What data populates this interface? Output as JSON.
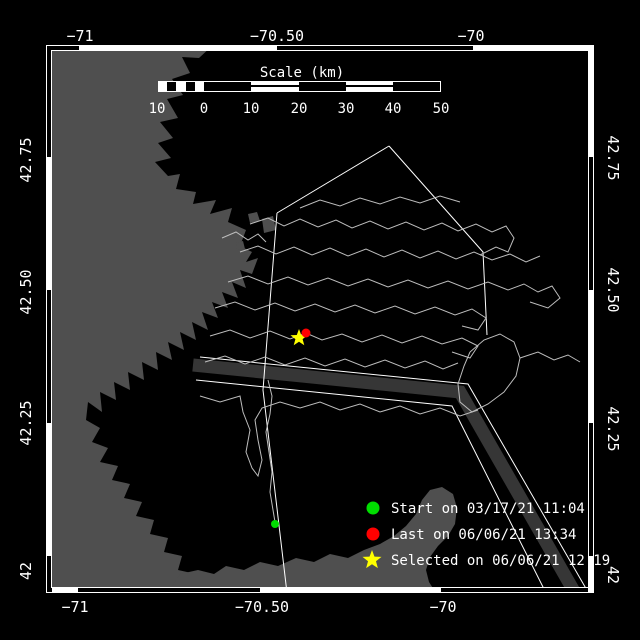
{
  "figure": {
    "width": 640,
    "height": 640,
    "bg": "#000000"
  },
  "map_colors": {
    "land": "#4f4f4f",
    "water": "#000000",
    "track": "#bdbdbd",
    "boundary_line": "#ffffff",
    "shipping_lane": "#363636",
    "frame": "#ffffff"
  },
  "axes": {
    "frame": {
      "x": 46,
      "y": 45,
      "w": 548,
      "h": 548
    },
    "top": {
      "baseline_y": 41,
      "labels": [
        {
          "text": "−71",
          "x": 80
        },
        {
          "text": "−70.50",
          "x": 277
        },
        {
          "text": "−70",
          "x": 471
        }
      ]
    },
    "bottom": {
      "baseline_y": 612,
      "labels": [
        {
          "text": "−71",
          "x": 75
        },
        {
          "text": "−70.50",
          "x": 262
        },
        {
          "text": "−70",
          "x": 443
        }
      ]
    },
    "left": {
      "x": 31,
      "labels": [
        {
          "text": "42.75",
          "y": 160
        },
        {
          "text": "42.50",
          "y": 292
        },
        {
          "text": "42.25",
          "y": 423
        },
        {
          "text": "42",
          "y": 571
        }
      ]
    },
    "right": {
      "x": 608,
      "labels": [
        {
          "text": "42.75",
          "y": 158
        },
        {
          "text": "42.50",
          "y": 290
        },
        {
          "text": "42.25",
          "y": 429
        },
        {
          "text": "42",
          "y": 575
        }
      ]
    },
    "border": {
      "thickness": 6,
      "top": {
        "boundaries": [
          46,
          79,
          277,
          473,
          594
        ],
        "first": "black"
      },
      "bottom": {
        "boundaries": [
          46,
          78,
          260,
          441,
          594
        ],
        "first": "white"
      },
      "left": {
        "boundaries": [
          45,
          157,
          290,
          423,
          556,
          593
        ],
        "first": "black"
      },
      "right": {
        "boundaries": [
          45,
          157,
          290,
          423,
          556,
          593
        ],
        "first": "white"
      }
    }
  },
  "scalebar": {
    "title": "Scale (km)",
    "title_x": 302,
    "title_y": 77,
    "bar": {
      "x": 158,
      "y": 81,
      "w": 283,
      "h": 11
    },
    "segments": [
      {
        "x1": 158,
        "x2": 167,
        "fill": "white",
        "striped": false
      },
      {
        "x1": 167,
        "x2": 176,
        "fill": "black",
        "striped": false
      },
      {
        "x1": 176,
        "x2": 186,
        "fill": "white",
        "striped": false
      },
      {
        "x1": 186,
        "x2": 195,
        "fill": "black",
        "striped": false
      },
      {
        "x1": 195,
        "x2": 204,
        "fill": "white",
        "striped": false
      },
      {
        "x1": 204,
        "x2": 251,
        "fill": "black",
        "striped": false
      },
      {
        "x1": 251,
        "x2": 299,
        "fill": "white",
        "striped": true
      },
      {
        "x1": 299,
        "x2": 346,
        "fill": "black",
        "striped": false
      },
      {
        "x1": 346,
        "x2": 393,
        "fill": "white",
        "striped": true
      },
      {
        "x1": 393,
        "x2": 441,
        "fill": "black",
        "striped": false
      }
    ],
    "ticks": [
      {
        "label": "10",
        "x": 157
      },
      {
        "label": "0",
        "x": 204
      },
      {
        "label": "10",
        "x": 251
      },
      {
        "label": "20",
        "x": 299
      },
      {
        "label": "30",
        "x": 346
      },
      {
        "label": "40",
        "x": 393
      },
      {
        "label": "50",
        "x": 441
      }
    ],
    "tick_baseline_y": 113
  },
  "legend": {
    "marker_x": 373,
    "label_x": 391,
    "row_y": [
      508,
      534,
      560
    ],
    "items": [
      {
        "id": "start",
        "marker": "circle",
        "color": "#00dd00",
        "label": "Start on 03/17/21 11:04"
      },
      {
        "id": "last",
        "marker": "circle",
        "color": "#ff0000",
        "label": "Last on 06/06/21 13:34"
      },
      {
        "id": "selected",
        "marker": "star",
        "color": "#ffff00",
        "label": "Selected on 06/06/21 12:19"
      }
    ]
  },
  "markers": {
    "start": {
      "x": 275,
      "y": 524,
      "r": 4,
      "color": "#00dd00"
    },
    "last": {
      "x": 306,
      "y": 333,
      "r": 4.5,
      "color": "#ff0000"
    },
    "selected": {
      "x": 299,
      "y": 338,
      "r": 9,
      "color": "#ffff00"
    }
  },
  "land_polygons": [
    [
      [
        46,
        45
      ],
      [
        213,
        45
      ],
      [
        199,
        58
      ],
      [
        182,
        57
      ],
      [
        190,
        73
      ],
      [
        172,
        79
      ],
      [
        183,
        95
      ],
      [
        167,
        99
      ],
      [
        178,
        118
      ],
      [
        160,
        122
      ],
      [
        173,
        138
      ],
      [
        158,
        143
      ],
      [
        171,
        158
      ],
      [
        155,
        162
      ],
      [
        168,
        176
      ],
      [
        180,
        174
      ],
      [
        176,
        189
      ],
      [
        196,
        192
      ],
      [
        193,
        204
      ],
      [
        216,
        200
      ],
      [
        210,
        214
      ],
      [
        232,
        208
      ],
      [
        228,
        222
      ],
      [
        246,
        230
      ],
      [
        240,
        246
      ],
      [
        252,
        252
      ],
      [
        246,
        262
      ],
      [
        258,
        258
      ],
      [
        252,
        274
      ],
      [
        240,
        270
      ],
      [
        246,
        288
      ],
      [
        232,
        282
      ],
      [
        238,
        298
      ],
      [
        222,
        292
      ],
      [
        228,
        308
      ],
      [
        212,
        302
      ],
      [
        218,
        318
      ],
      [
        202,
        312
      ],
      [
        208,
        330
      ],
      [
        192,
        322
      ],
      [
        196,
        340
      ],
      [
        180,
        332
      ],
      [
        184,
        350
      ],
      [
        168,
        342
      ],
      [
        172,
        360
      ],
      [
        156,
        352
      ],
      [
        158,
        370
      ],
      [
        142,
        362
      ],
      [
        144,
        380
      ],
      [
        128,
        372
      ],
      [
        130,
        390
      ],
      [
        114,
        382
      ],
      [
        116,
        400
      ],
      [
        100,
        392
      ],
      [
        102,
        412
      ],
      [
        88,
        402
      ],
      [
        86,
        420
      ],
      [
        100,
        428
      ],
      [
        92,
        442
      ],
      [
        108,
        448
      ],
      [
        100,
        462
      ],
      [
        118,
        466
      ],
      [
        112,
        480
      ],
      [
        130,
        484
      ],
      [
        124,
        498
      ],
      [
        142,
        502
      ],
      [
        136,
        516
      ],
      [
        154,
        520
      ],
      [
        150,
        534
      ],
      [
        168,
        538
      ],
      [
        164,
        552
      ],
      [
        182,
        556
      ],
      [
        178,
        570
      ],
      [
        196,
        574
      ],
      [
        192,
        588
      ],
      [
        210,
        592
      ],
      [
        208,
        593
      ],
      [
        46,
        593
      ]
    ],
    [
      [
        168,
        593
      ],
      [
        180,
        574
      ],
      [
        198,
        570
      ],
      [
        214,
        574
      ],
      [
        226,
        566
      ],
      [
        244,
        570
      ],
      [
        260,
        562
      ],
      [
        278,
        566
      ],
      [
        296,
        558
      ],
      [
        314,
        562
      ],
      [
        330,
        554
      ],
      [
        348,
        558
      ],
      [
        364,
        550
      ],
      [
        380,
        544
      ],
      [
        394,
        536
      ],
      [
        406,
        526
      ],
      [
        416,
        514
      ],
      [
        422,
        500
      ],
      [
        430,
        490
      ],
      [
        442,
        487
      ],
      [
        453,
        494
      ],
      [
        457,
        508
      ],
      [
        455,
        524
      ],
      [
        448,
        536
      ],
      [
        438,
        546
      ],
      [
        430,
        557
      ],
      [
        426,
        570
      ],
      [
        429,
        582
      ],
      [
        436,
        593
      ]
    ],
    [
      [
        248,
        214
      ],
      [
        257,
        212
      ],
      [
        260,
        221
      ],
      [
        250,
        223
      ]
    ],
    [
      [
        262,
        219
      ],
      [
        273,
        216
      ],
      [
        276,
        230
      ],
      [
        264,
        233
      ]
    ],
    [
      [
        236,
        243
      ],
      [
        243,
        241
      ],
      [
        245,
        249
      ],
      [
        237,
        250
      ]
    ]
  ],
  "shipping_lane": {
    "width": 13,
    "points": [
      [
        193,
        365
      ],
      [
        460,
        392
      ],
      [
        575,
        593
      ]
    ]
  },
  "boundary_lines": [
    [
      [
        277,
        213
      ],
      [
        389,
        146
      ]
    ],
    [
      [
        389,
        146
      ],
      [
        483,
        252
      ],
      [
        487,
        335
      ]
    ],
    [
      [
        277,
        213
      ],
      [
        263,
        390
      ],
      [
        287,
        593
      ]
    ],
    [
      [
        200,
        357
      ],
      [
        468,
        384
      ],
      [
        588,
        592
      ]
    ],
    [
      [
        196,
        380
      ],
      [
        452,
        406
      ],
      [
        546,
        593
      ]
    ]
  ],
  "tracks": [
    [
      [
        250,
        224
      ],
      [
        268,
        218
      ],
      [
        284,
        226
      ],
      [
        300,
        219
      ],
      [
        318,
        227
      ],
      [
        336,
        220
      ],
      [
        352,
        228
      ],
      [
        370,
        221
      ],
      [
        388,
        229
      ],
      [
        406,
        222
      ],
      [
        424,
        230
      ],
      [
        442,
        223
      ],
      [
        458,
        231
      ],
      [
        476,
        224
      ],
      [
        492,
        232
      ],
      [
        506,
        226
      ],
      [
        514,
        238
      ],
      [
        508,
        252
      ],
      [
        496,
        247
      ],
      [
        480,
        255
      ]
    ],
    [
      [
        240,
        252
      ],
      [
        258,
        246
      ],
      [
        276,
        254
      ],
      [
        294,
        247
      ],
      [
        312,
        255
      ],
      [
        330,
        248
      ],
      [
        348,
        256
      ],
      [
        366,
        249
      ],
      [
        384,
        257
      ],
      [
        402,
        250
      ],
      [
        420,
        258
      ],
      [
        438,
        251
      ],
      [
        456,
        259
      ],
      [
        474,
        252
      ],
      [
        492,
        260
      ],
      [
        510,
        254
      ],
      [
        526,
        262
      ],
      [
        540,
        256
      ]
    ],
    [
      [
        228,
        282
      ],
      [
        248,
        276
      ],
      [
        268,
        284
      ],
      [
        288,
        277
      ],
      [
        308,
        285
      ],
      [
        328,
        278
      ],
      [
        348,
        286
      ],
      [
        368,
        279
      ],
      [
        388,
        287
      ],
      [
        408,
        280
      ],
      [
        428,
        288
      ],
      [
        448,
        281
      ],
      [
        468,
        289
      ],
      [
        488,
        282
      ],
      [
        508,
        290
      ],
      [
        524,
        284
      ],
      [
        538,
        292
      ],
      [
        552,
        286
      ],
      [
        560,
        298
      ],
      [
        548,
        308
      ],
      [
        530,
        302
      ]
    ],
    [
      [
        215,
        308
      ],
      [
        235,
        302
      ],
      [
        255,
        310
      ],
      [
        275,
        303
      ],
      [
        295,
        311
      ],
      [
        315,
        304
      ],
      [
        335,
        312
      ],
      [
        355,
        305
      ],
      [
        375,
        313
      ],
      [
        395,
        306
      ],
      [
        415,
        314
      ],
      [
        435,
        307
      ],
      [
        455,
        315
      ],
      [
        472,
        309
      ],
      [
        486,
        318
      ],
      [
        478,
        330
      ],
      [
        462,
        326
      ]
    ],
    [
      [
        210,
        336
      ],
      [
        230,
        330
      ],
      [
        250,
        338
      ],
      [
        270,
        331
      ],
      [
        290,
        339
      ],
      [
        306,
        333
      ],
      [
        322,
        340
      ],
      [
        342,
        334
      ],
      [
        362,
        342
      ],
      [
        382,
        335
      ],
      [
        402,
        343
      ],
      [
        422,
        336
      ],
      [
        442,
        344
      ],
      [
        462,
        338
      ],
      [
        478,
        346
      ],
      [
        470,
        358
      ],
      [
        452,
        352
      ]
    ],
    [
      [
        205,
        362
      ],
      [
        225,
        356
      ],
      [
        245,
        364
      ],
      [
        265,
        357
      ],
      [
        285,
        365
      ],
      [
        305,
        358
      ],
      [
        325,
        366
      ],
      [
        345,
        359
      ],
      [
        365,
        367
      ],
      [
        385,
        360
      ],
      [
        405,
        368
      ],
      [
        425,
        361
      ],
      [
        443,
        369
      ],
      [
        458,
        363
      ]
    ],
    [
      [
        200,
        396
      ],
      [
        220,
        402
      ],
      [
        240,
        396
      ],
      [
        243,
        412
      ],
      [
        250,
        430
      ],
      [
        246,
        452
      ],
      [
        252,
        468
      ],
      [
        258,
        476
      ],
      [
        262,
        460
      ],
      [
        258,
        440
      ],
      [
        255,
        420
      ],
      [
        262,
        408
      ],
      [
        280,
        402
      ],
      [
        300,
        408
      ],
      [
        320,
        402
      ],
      [
        340,
        410
      ],
      [
        360,
        404
      ],
      [
        380,
        412
      ],
      [
        400,
        406
      ],
      [
        420,
        414
      ],
      [
        440,
        408
      ],
      [
        460,
        416
      ],
      [
        478,
        410
      ]
    ],
    [
      [
        268,
        380
      ],
      [
        272,
        396
      ],
      [
        270,
        414
      ],
      [
        266,
        432
      ],
      [
        269,
        452
      ],
      [
        272,
        472
      ],
      [
        270,
        492
      ],
      [
        273,
        510
      ],
      [
        275,
        522
      ]
    ],
    [
      [
        470,
        352
      ],
      [
        484,
        340
      ],
      [
        500,
        334
      ],
      [
        514,
        342
      ],
      [
        520,
        358
      ],
      [
        516,
        376
      ],
      [
        504,
        392
      ],
      [
        488,
        404
      ],
      [
        472,
        412
      ],
      [
        460,
        402
      ],
      [
        458,
        384
      ],
      [
        464,
        366
      ],
      [
        470,
        352
      ]
    ],
    [
      [
        300,
        208
      ],
      [
        320,
        200
      ],
      [
        340,
        206
      ],
      [
        360,
        198
      ],
      [
        380,
        204
      ],
      [
        400,
        197
      ],
      [
        420,
        203
      ],
      [
        440,
        196
      ],
      [
        460,
        202
      ]
    ],
    [
      [
        222,
        238
      ],
      [
        236,
        232
      ],
      [
        248,
        240
      ],
      [
        258,
        234
      ],
      [
        266,
        242
      ]
    ],
    [
      [
        520,
        358
      ],
      [
        538,
        352
      ],
      [
        554,
        360
      ],
      [
        568,
        355
      ],
      [
        580,
        362
      ]
    ]
  ]
}
